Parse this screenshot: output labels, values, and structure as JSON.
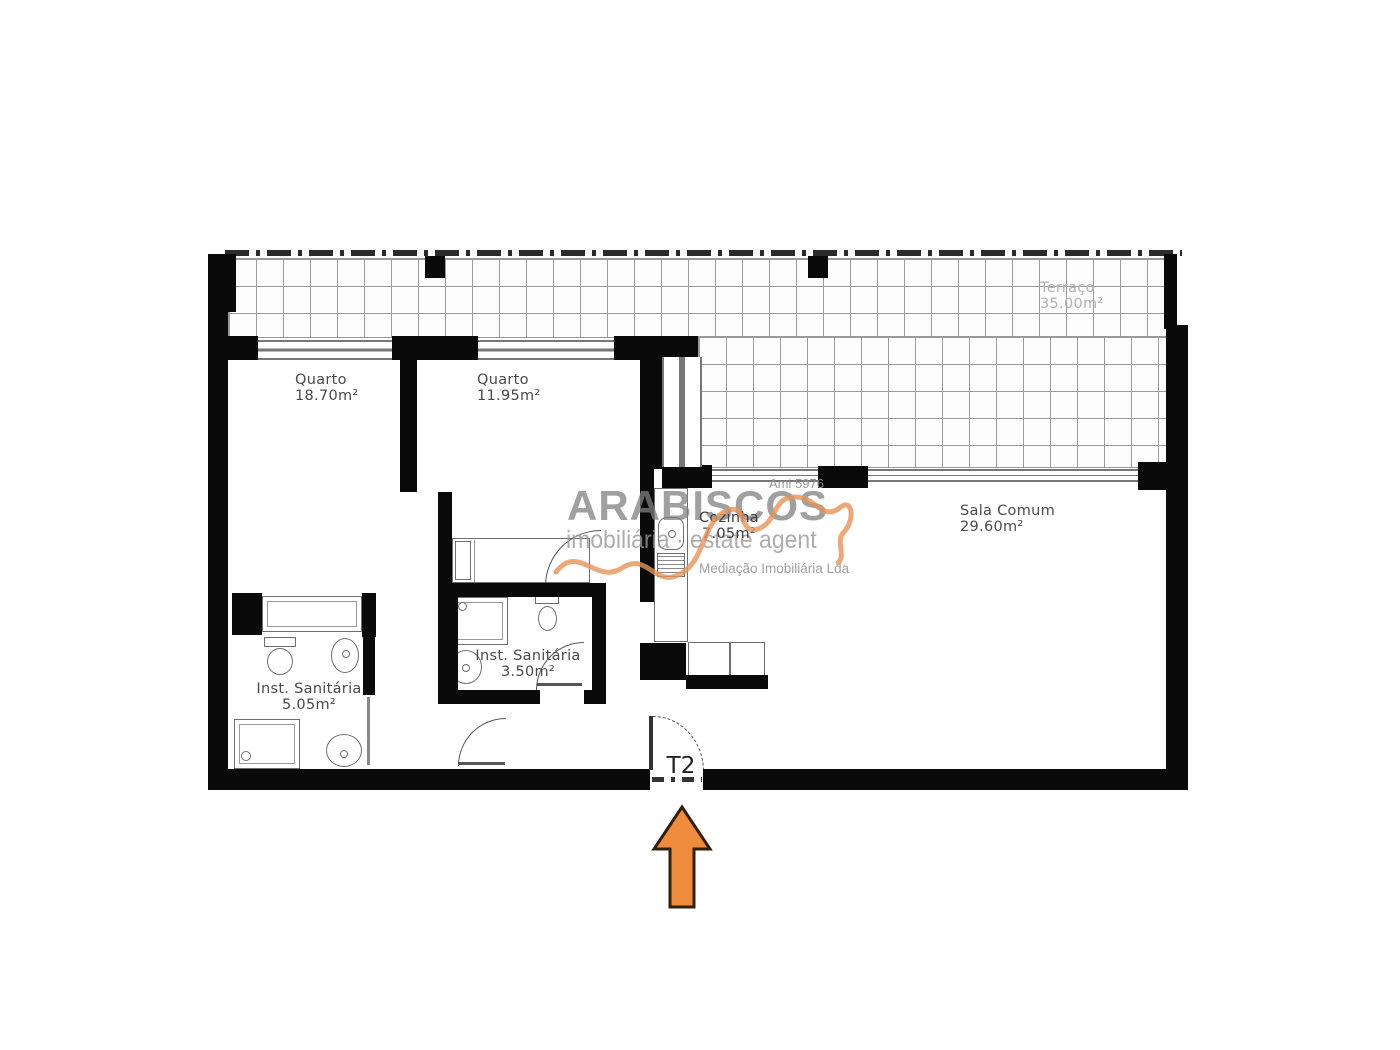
{
  "entrance": {
    "label": "T2"
  },
  "rooms": {
    "quarto1": {
      "name": "Quarto",
      "area": "18.70m²"
    },
    "quarto2": {
      "name": "Quarto",
      "area": "11.95m²"
    },
    "terraco": {
      "name": "Terraço",
      "area": "35.00m²"
    },
    "cozinha": {
      "name": "Cozinha",
      "area": "7.05m²"
    },
    "sala": {
      "name": "Sala Comum",
      "area": "29.60m²"
    },
    "wc1": {
      "name": "Inst. Sanitária",
      "area": "5.05m²"
    },
    "wc2": {
      "name": "Inst. Sanitária",
      "area": "3.50m²"
    }
  },
  "watermark": {
    "license_no": "Ami 5976",
    "brand": "ARABISCOS",
    "tagline_left": "imobiliária",
    "separator": "·",
    "tagline_right": "estate agent",
    "subtitle": "Mediação Imobiliária Lda"
  },
  "colors": {
    "wall": "#0a0a0a",
    "tile_line": "#9b9b9b",
    "label": "#4a4a4a",
    "label_faint": "#b2b2b2",
    "fixture": "#6e6e6e",
    "arrow": "#ef8b3d",
    "arrow_outline": "#33200a",
    "watermark": "#828282",
    "accent": "#e6935a"
  }
}
